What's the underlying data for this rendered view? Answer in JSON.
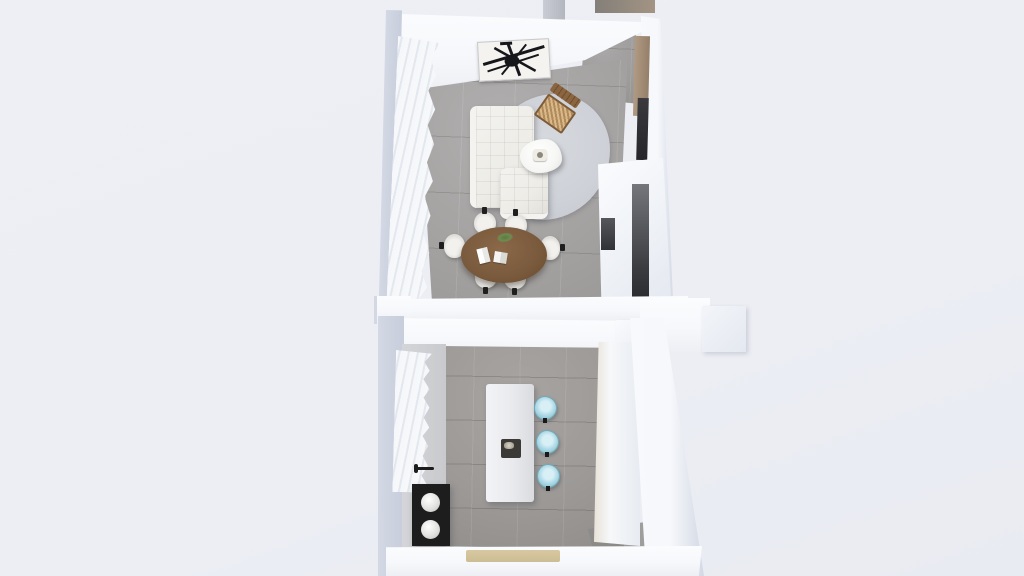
{
  "scene": {
    "type": "3d-floorplan-top-down-render",
    "label": "Two-room apartment 3D floor plan",
    "rooms_count": 2,
    "has_text": false
  },
  "rooms": {
    "living": {
      "label": "Living and dining room",
      "floor": "gray concrete tiles",
      "objects": [
        {
          "name": "abstract-wall-art",
          "count": 1
        },
        {
          "name": "sheer-curtain-wall",
          "count": 1
        },
        {
          "name": "l-shaped-sectional-sofa",
          "count": 1
        },
        {
          "name": "organic-shape-rug",
          "count": 1
        },
        {
          "name": "organic-coffee-table",
          "count": 1
        },
        {
          "name": "cane-accent-chair",
          "count": 1
        },
        {
          "name": "oval-dining-table",
          "count": 1
        },
        {
          "name": "dining-chair",
          "count": 6
        },
        {
          "name": "table-books",
          "count": 2
        },
        {
          "name": "table-plant-sprig",
          "count": 1
        },
        {
          "name": "wood-wall-panel",
          "count": 1
        },
        {
          "name": "wall-tv-panel",
          "count": 1
        },
        {
          "name": "built-in-closet",
          "count": 1
        }
      ]
    },
    "kitchen": {
      "label": "Kitchen",
      "floor": "warm gray tiles",
      "objects": [
        {
          "name": "sheer-curtain-wall",
          "count": 1
        },
        {
          "name": "kitchen-counter-left",
          "count": 1
        },
        {
          "name": "black-sink-cooktop-unit",
          "count": 1
        },
        {
          "name": "wall-faucet",
          "count": 1
        },
        {
          "name": "kitchen-island",
          "count": 1
        },
        {
          "name": "island-sink",
          "count": 1
        },
        {
          "name": "bar-stool",
          "count": 3
        },
        {
          "name": "kitchen-counter-right",
          "count": 1
        },
        {
          "name": "doormat",
          "count": 1
        }
      ]
    }
  },
  "colors": {
    "bg": "#edeff5",
    "wall_face": "#f6f8fb",
    "wall_side": "#d3d8e4",
    "floor_living": "#a5a3a2",
    "floor_kitchen": "#9c9997",
    "rug": "#ced1d7",
    "sofa": "#edece7",
    "coffee_table": "#f6f6f4",
    "wood_chair": "#ab8257",
    "dining_table": "#7a5a3d",
    "chair_seat": "#eceae6",
    "chair_leg": "#1f1f1f",
    "island": "#e9eaed",
    "island_sink": "#3c3a36",
    "stool": "#a9d8e4",
    "stool_rim": "#74a9ba",
    "counter_left": "#c9cacd",
    "black_unit": "#1d1d1d",
    "curtain": "#f7f8fa",
    "art_stroke": "#16171b",
    "art_bg": "#f4f3f0",
    "shelf_wood": "#b19a83",
    "tv_panel": "#26262a",
    "doormat": "#d8c8a2",
    "hall_stub": "#b3b6be",
    "hall_stub_dark": "#837f79",
    "closet_slot": "#3a3c40"
  }
}
